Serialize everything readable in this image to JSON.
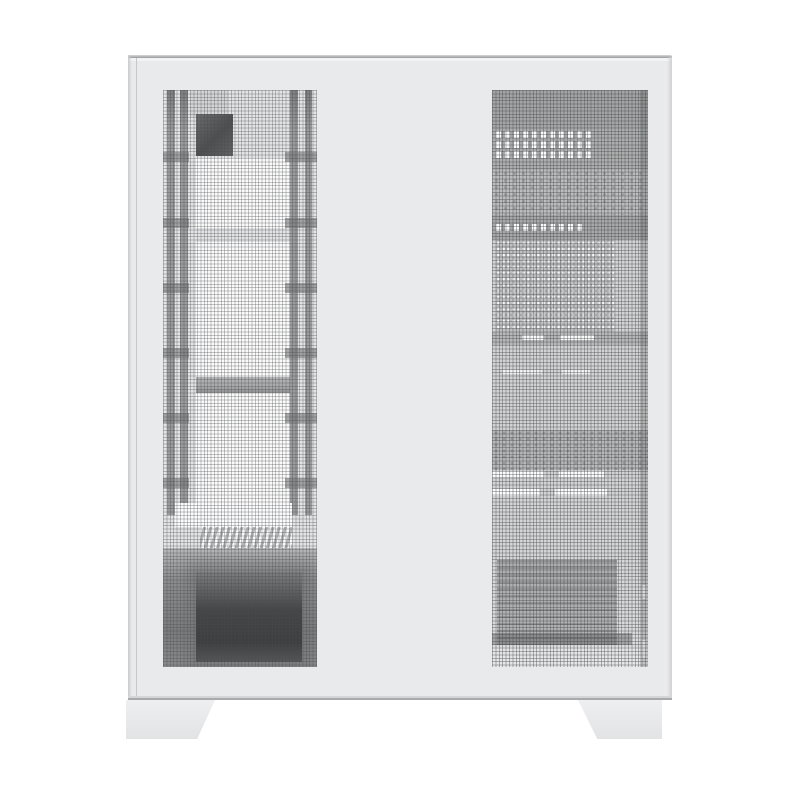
{
  "scene": {
    "type": "product-photo",
    "subject": "white mid-tower PC case, front-left view, perforated mesh front strip and side panel, two trapezoid feet",
    "visible_text": "",
    "background": "#ffffff"
  },
  "palette": {
    "bg": "#ffffff",
    "body": "#e9eaeb",
    "edge_top": "#97999b",
    "edge_line": "#c6c7c8",
    "mesh_left_base": "#e3e4e5",
    "mesh_right_base": "#d4d5d6",
    "interior_white": "#fbfbfb",
    "rail": "#9a9b9c",
    "rail_dark": "#7e7f80",
    "bar": "#a9aaab",
    "psu_core": "#454647",
    "slot_white": "#ffffff",
    "bottom_line": "#a8aaac",
    "foot": "#ebeced",
    "foot_edge": "#d2d3d4"
  },
  "parts": {
    "case_body": "case body",
    "front_mesh_panel": "front perforated mesh strip",
    "side_mesh_panel": "side perforated mesh panel",
    "mounting_rails": "internal radiator mounting rails (4, seen through mesh)",
    "rail_tabs": "bracket tabs on rails",
    "bracket_openings": "bright interior openings between rails (3)",
    "fan_bracket_bar": "horizontal bracket bar",
    "internal_component_block": "dark component block, upper left interior",
    "psu_bay": "power-supply bay, dark block behind lower mesh",
    "psu_vent_grille": "diagonal vent grille above PSU",
    "vent_slot_rows": "white vent slot rows behind side mesh",
    "feet": [
      "left trapezoid foot",
      "right trapezoid foot"
    ]
  }
}
